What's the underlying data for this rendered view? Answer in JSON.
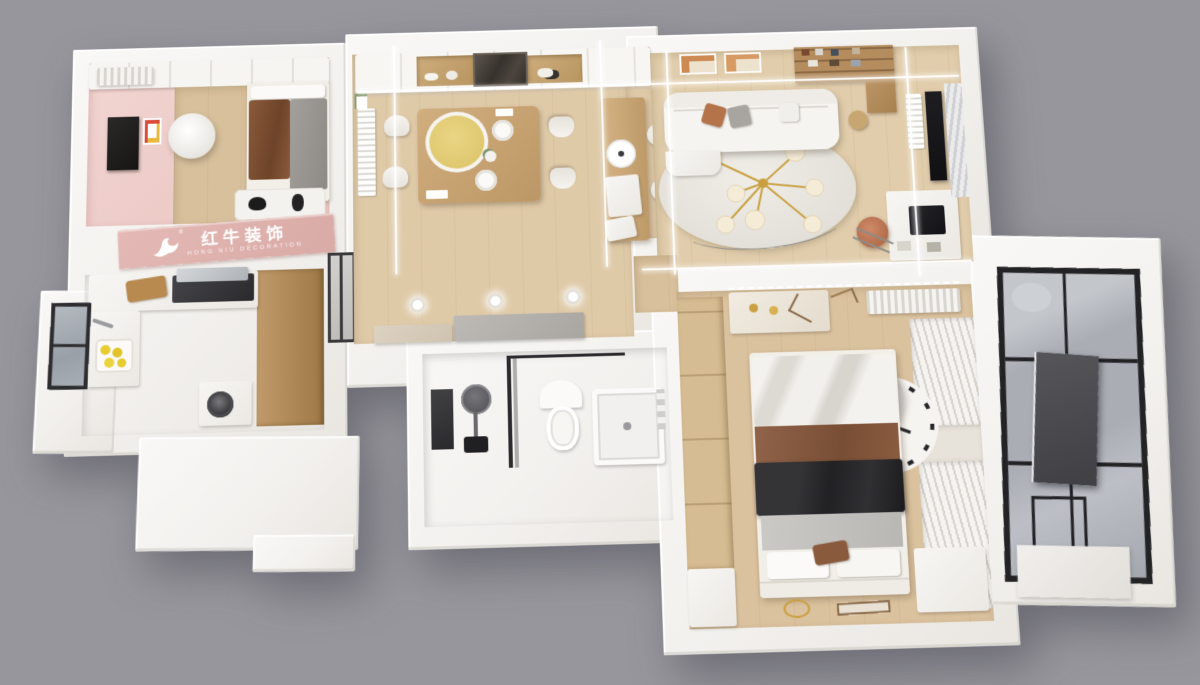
{
  "scene": {
    "type": "3d-axonometric-floorplan-render",
    "background_color": "#97969c",
    "palette": {
      "wall_white": "#f6f5f2",
      "wall_shade": "#e9e6e1",
      "wood_floor": "#dfcaa8",
      "wood_floor_dark": "#d7bd98",
      "kitchen_tile": "#cac2b9",
      "bathroom_tile": "#d7d5d3",
      "pink_room": "#f0d0cd",
      "pink_logo_wall": "#deb2ae",
      "cabinet_wood": "#b4905f",
      "dark_glass": "#3c3a38",
      "black_fabric": "#2c2c2e",
      "blanket_brown": "#85583a",
      "turntable_yellow": "#e3cd78",
      "lemon_yellow": "#e8cc30",
      "gold_accent": "#c9a040",
      "leather_chair": "#c07a5c",
      "balcony_glass": "#b3b6bc",
      "frame_black": "#232326",
      "led_line_white": "#ffffff"
    }
  },
  "watermark": {
    "brand_cn": "红牛装饰",
    "brand_en": "HONG NIU DECORATION",
    "text_color": "#ffffff"
  },
  "rooms": [
    {
      "name": "kids-bedroom",
      "furniture": [
        "wardrobe",
        "air-conditioner",
        "single-bed",
        "brown-blanket",
        "gray-quilt",
        "desk-tv",
        "wall-poster",
        "round-ceiling-lamp",
        "rug-with-plush-toys",
        "pink-logo-wall"
      ]
    },
    {
      "name": "kitchen",
      "furniture": [
        "l-shaped-counter",
        "cooktop",
        "range-hood",
        "cutting-board",
        "sink",
        "lemon-tray",
        "black-frame-window",
        "tall-wood-cabinets",
        "washing-machine"
      ]
    },
    {
      "name": "dining-room",
      "furniture": [
        "wall-cabinets",
        "wood-niche-shelves",
        "dark-glass-display-cabinet",
        "dining-table",
        "yellow-turntable",
        "white-chairs-x4",
        "plates",
        "flower-vase",
        "radiator",
        "wall-art"
      ]
    },
    {
      "name": "bar-counter",
      "furniture": [
        "wood-island",
        "paper-roll",
        "white-cube",
        "bar-stools-x2"
      ]
    },
    {
      "name": "living-room",
      "furniture": [
        "white-sofa",
        "throw-pillows",
        "round-rug",
        "gold-chandelier",
        "floor-lamp-wire",
        "art-frames-x2",
        "wood-bookshelf",
        "side-table",
        "work-desk",
        "monitor",
        "leather-office-chair",
        "wall-tv-panel",
        "window-blinds",
        "radiator"
      ]
    },
    {
      "name": "hallway",
      "furniture": [
        "recessed-downlights-x3",
        "gray-cabinet",
        "beige-cabinet",
        "sliding-glass-door",
        "doorway-threshold"
      ]
    },
    {
      "name": "bathroom",
      "furniture": [
        "dark-mirror",
        "round-basin",
        "black-fixture",
        "glass-partition",
        "toilet",
        "shower-base",
        "wall-fixtures"
      ]
    },
    {
      "name": "master-bedroom",
      "furniture": [
        "double-bed",
        "white-drape",
        "brown-sheet",
        "black-blanket",
        "gray-quilt",
        "pillows",
        "wood-wardrobe",
        "dresser",
        "gold-candles",
        "ac-vent",
        "dotted-led-strip",
        "pleated-curtains",
        "clock-face-rug",
        "paper-lamp",
        "bench",
        "gold-floor-ring"
      ]
    },
    {
      "name": "balcony",
      "furniture": [
        "black-frame-glass-wall",
        "dark-gray-panel",
        "white-ledge"
      ]
    }
  ],
  "lighting": {
    "led_strips": [
      "vertical-x4-over-dining-living",
      "horizontal-x2-over-dining-living"
    ],
    "downlights": 3
  }
}
